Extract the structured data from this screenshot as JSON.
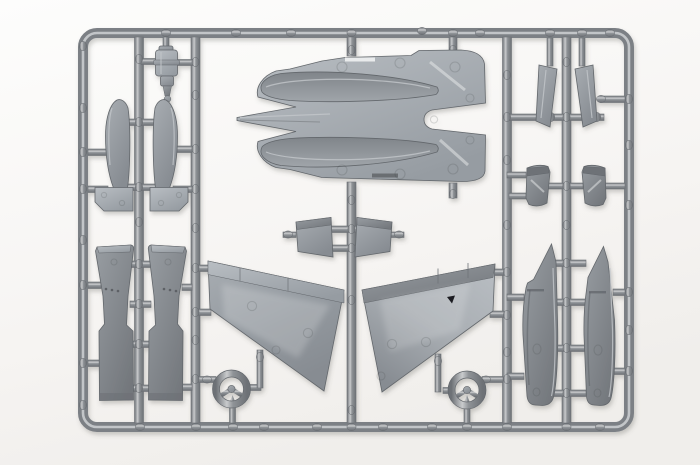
{
  "meta": {
    "subject": "photograph of a gray injection-molded model kit sprue (parts runner) for an aircraft kit on a white studio background",
    "text_content": "none - image contains no readable text"
  },
  "colors": {
    "bg_top": "#fdfdfc",
    "bg_bottom": "#f0eeeb",
    "bg_corner": "#f6f4f2",
    "runner_edge": "#6d7176",
    "runner_mid": "#8f9397",
    "runner_hi": "#c9cbcd",
    "frame_base": "#7c8085",
    "frame_hi": "#c2c5c8",
    "part_edge": "#63676c",
    "part_hi": "#c3c7cb",
    "part_light_a": "#b9bec3",
    "part_light_b": "#969ca2",
    "part_mid_a": "#a8adb2",
    "part_mid_b": "#878c92",
    "part_dark_a": "#989da2",
    "part_dark_b": "#73777c",
    "trough_a": "#80858a",
    "trough_b": "#a0a5aa",
    "ej_ring": "rgba(60,64,68,0.18)",
    "detail_light": "#e9ebec",
    "detail_dark": "#6a6e72",
    "speck": "#1d1f21",
    "shadow": "rgba(90,88,84,0.30)"
  },
  "inventory": {
    "frame": "rectangular sprue frame with rounded corners and five vertical runners",
    "parts": [
      "upper fuselage panel with nose spike and twin engine troughs (top center)",
      "left wing panel with flap band (center left)",
      "right wing panel with flap band (center right)",
      "two drop-tank halves with fin plates (upper left column)",
      "two engine nacelle halves (lower left column)",
      "nose gear strut (top left)",
      "two ventral fin plates (center, small trapezoids)",
      "two intake wedge halves (upper right)",
      "two intake lip pieces (middle right)",
      "two tail boom halves with pointed fins (lower right)",
      "two three-spoke wheels (bottom, left and right of center)"
    ]
  }
}
